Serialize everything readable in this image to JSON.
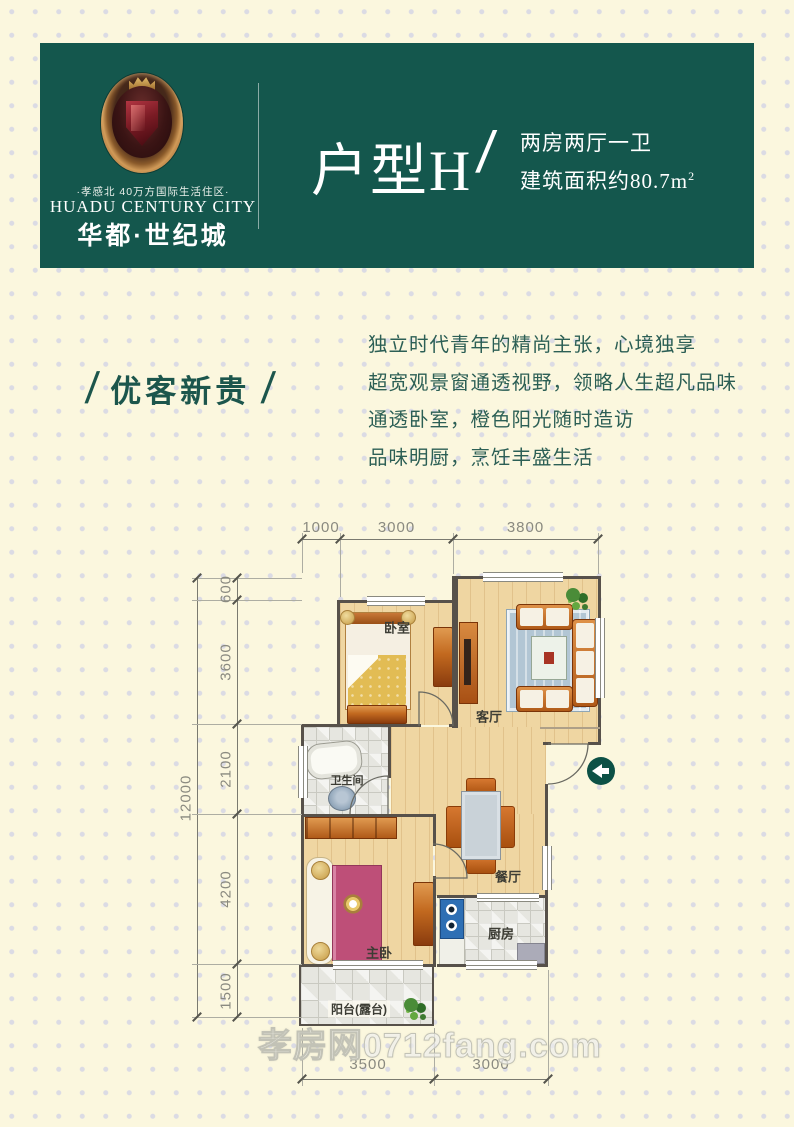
{
  "page": {
    "background": "#FBF7DE",
    "dot_color": "#DBDBE4"
  },
  "header": {
    "background": "#14574D",
    "brand": {
      "tagline": "·孝感北 40万方国际生活住区·",
      "name_en": "HUADU CENTURY CITY",
      "name_cn": "华都·世纪城"
    },
    "unit": {
      "title": "户型H",
      "slash": "/",
      "spec_rooms": "两房两厅一卫",
      "spec_area_prefix": "建筑面积约80.7m",
      "spec_area_sup": "2"
    }
  },
  "intro": {
    "slash_left": "/",
    "title": "优客新贵",
    "slash_right": "/",
    "lines": [
      "独立时代青年的精尚主张，心境独享",
      "超宽观景窗通透视野，领略人生超凡品味",
      "通透卧室，橙色阳光随时造访",
      "品味明厨，烹饪丰盛生活"
    ]
  },
  "floorplan": {
    "entry_arrow_color": "#0C5146",
    "room_labels": {
      "bedroom": "卧室",
      "living": "客厅",
      "bathroom": "卫生间",
      "dining": "餐厅",
      "master": "主卧",
      "kitchen": "厨房",
      "balcony": "阳台(露台)"
    },
    "dimensions": {
      "top": [
        "1000",
        "3000",
        "3800"
      ],
      "left_segments": [
        "600",
        "3600",
        "2100",
        "4200",
        "1500"
      ],
      "left_total": "12000",
      "bottom": [
        "3500",
        "3000"
      ]
    }
  },
  "watermark": "孝房网0712fang.com"
}
